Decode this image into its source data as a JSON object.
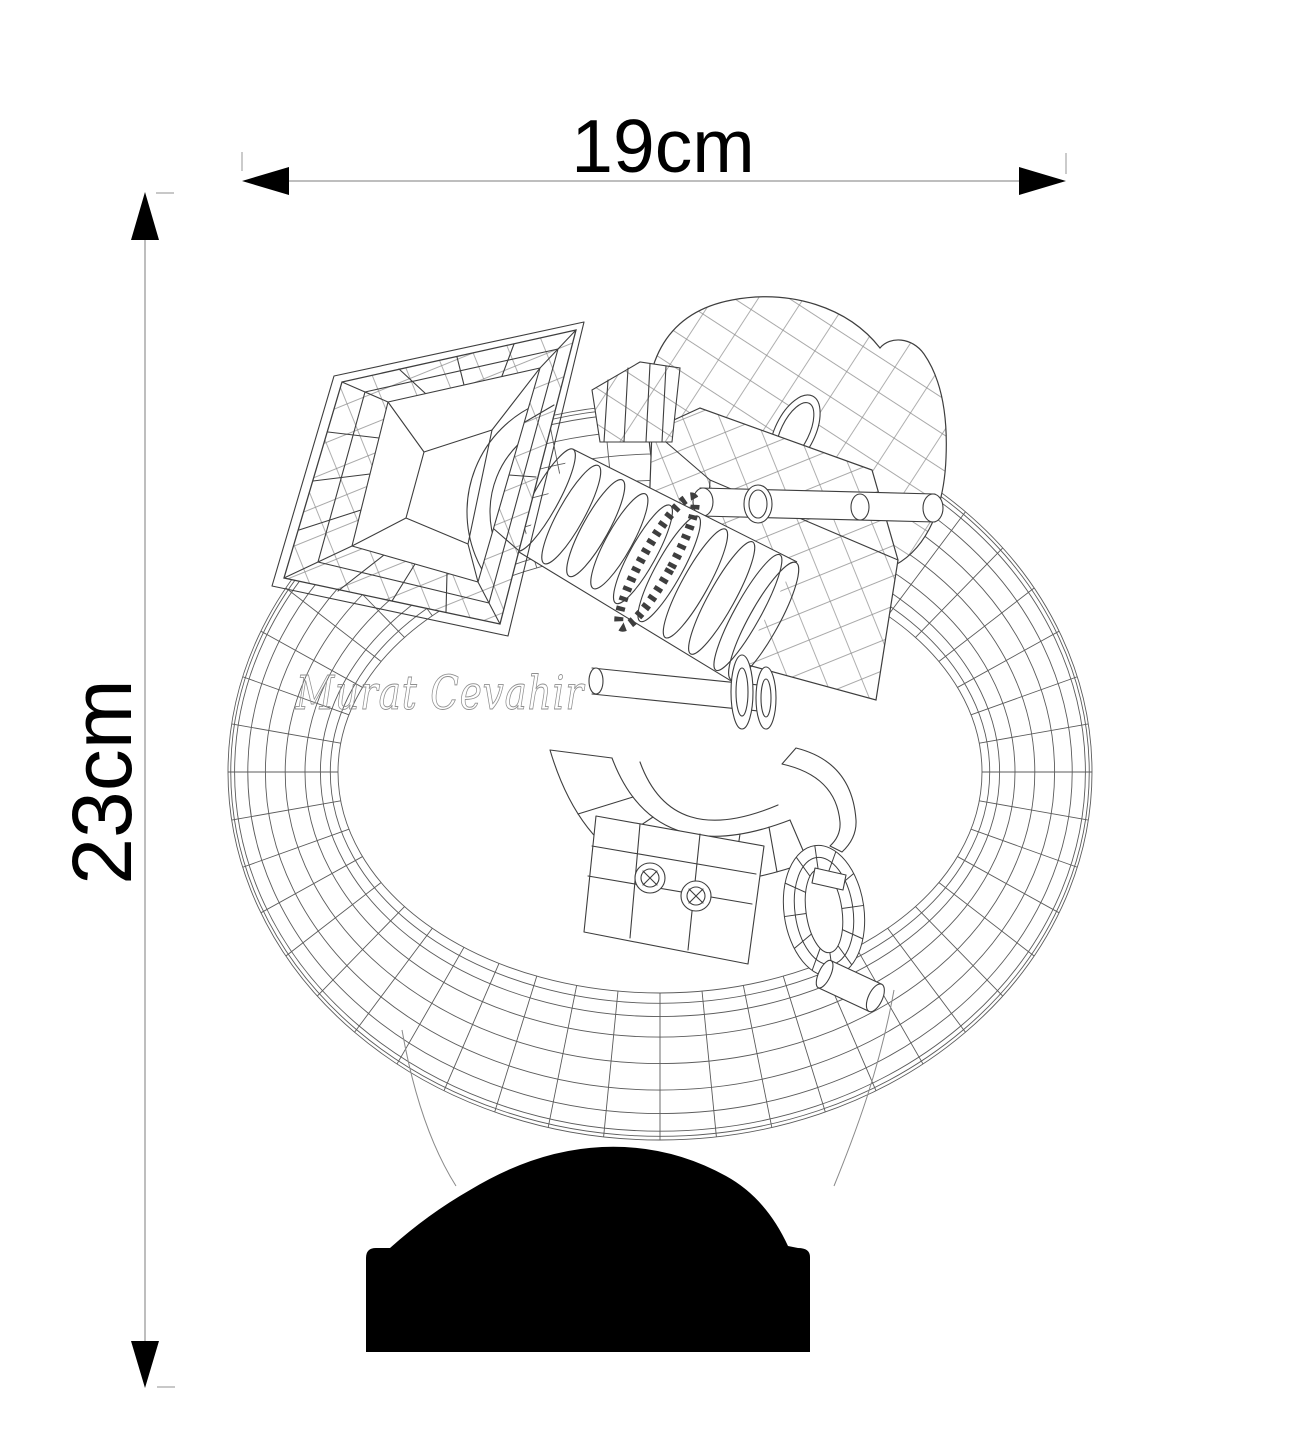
{
  "page": {
    "background": "#ffffff"
  },
  "dimensions": {
    "width": {
      "label": "19cm"
    },
    "height": {
      "label": "23cm"
    }
  },
  "watermark": {
    "text": "Murat Cevahir"
  },
  "colors": {
    "drawing_line": "#3e3e3e",
    "ring_line": "#5b5b5b",
    "dimension_line": "#a8a8a8",
    "arrow": "#000000",
    "text": "#000000",
    "base_silhouette": "#000000",
    "watermark_line": "#8f8f8f"
  }
}
